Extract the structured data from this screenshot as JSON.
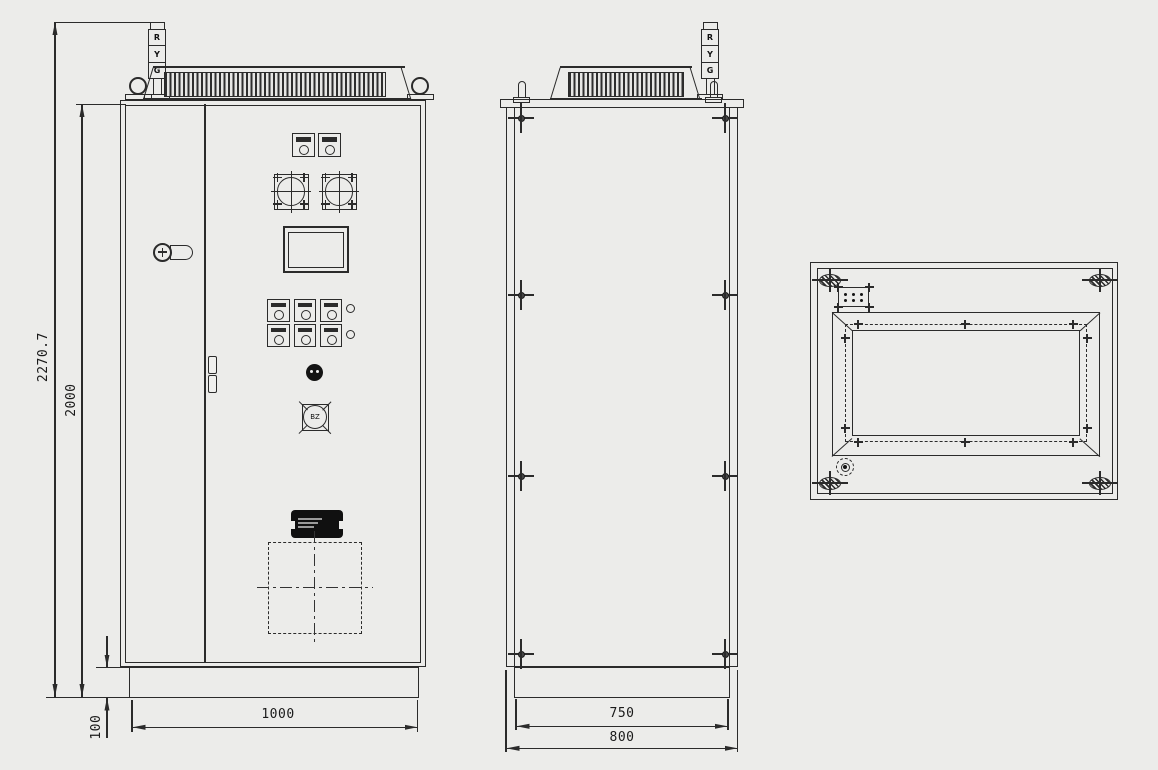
{
  "palette": {
    "background": "#ECECEA",
    "line": "#2B2B2B"
  },
  "front_view": {
    "signal_tower": {
      "segments": [
        "R",
        "Y",
        "G"
      ]
    },
    "buzzer": {
      "label": "BZ"
    },
    "dimensions": {
      "overall_height": "2270.7",
      "body_height": "2000",
      "base_height": "100",
      "width": "1000"
    }
  },
  "side_view": {
    "signal_tower": {
      "segments": [
        "R",
        "Y",
        "G"
      ]
    },
    "dimensions": {
      "base_depth": "750",
      "overall_depth": "800"
    }
  },
  "top_view": {
    "features": [
      "lifting-eyes",
      "cable-entry-plate",
      "roof-opening",
      "lamp-hole"
    ]
  }
}
